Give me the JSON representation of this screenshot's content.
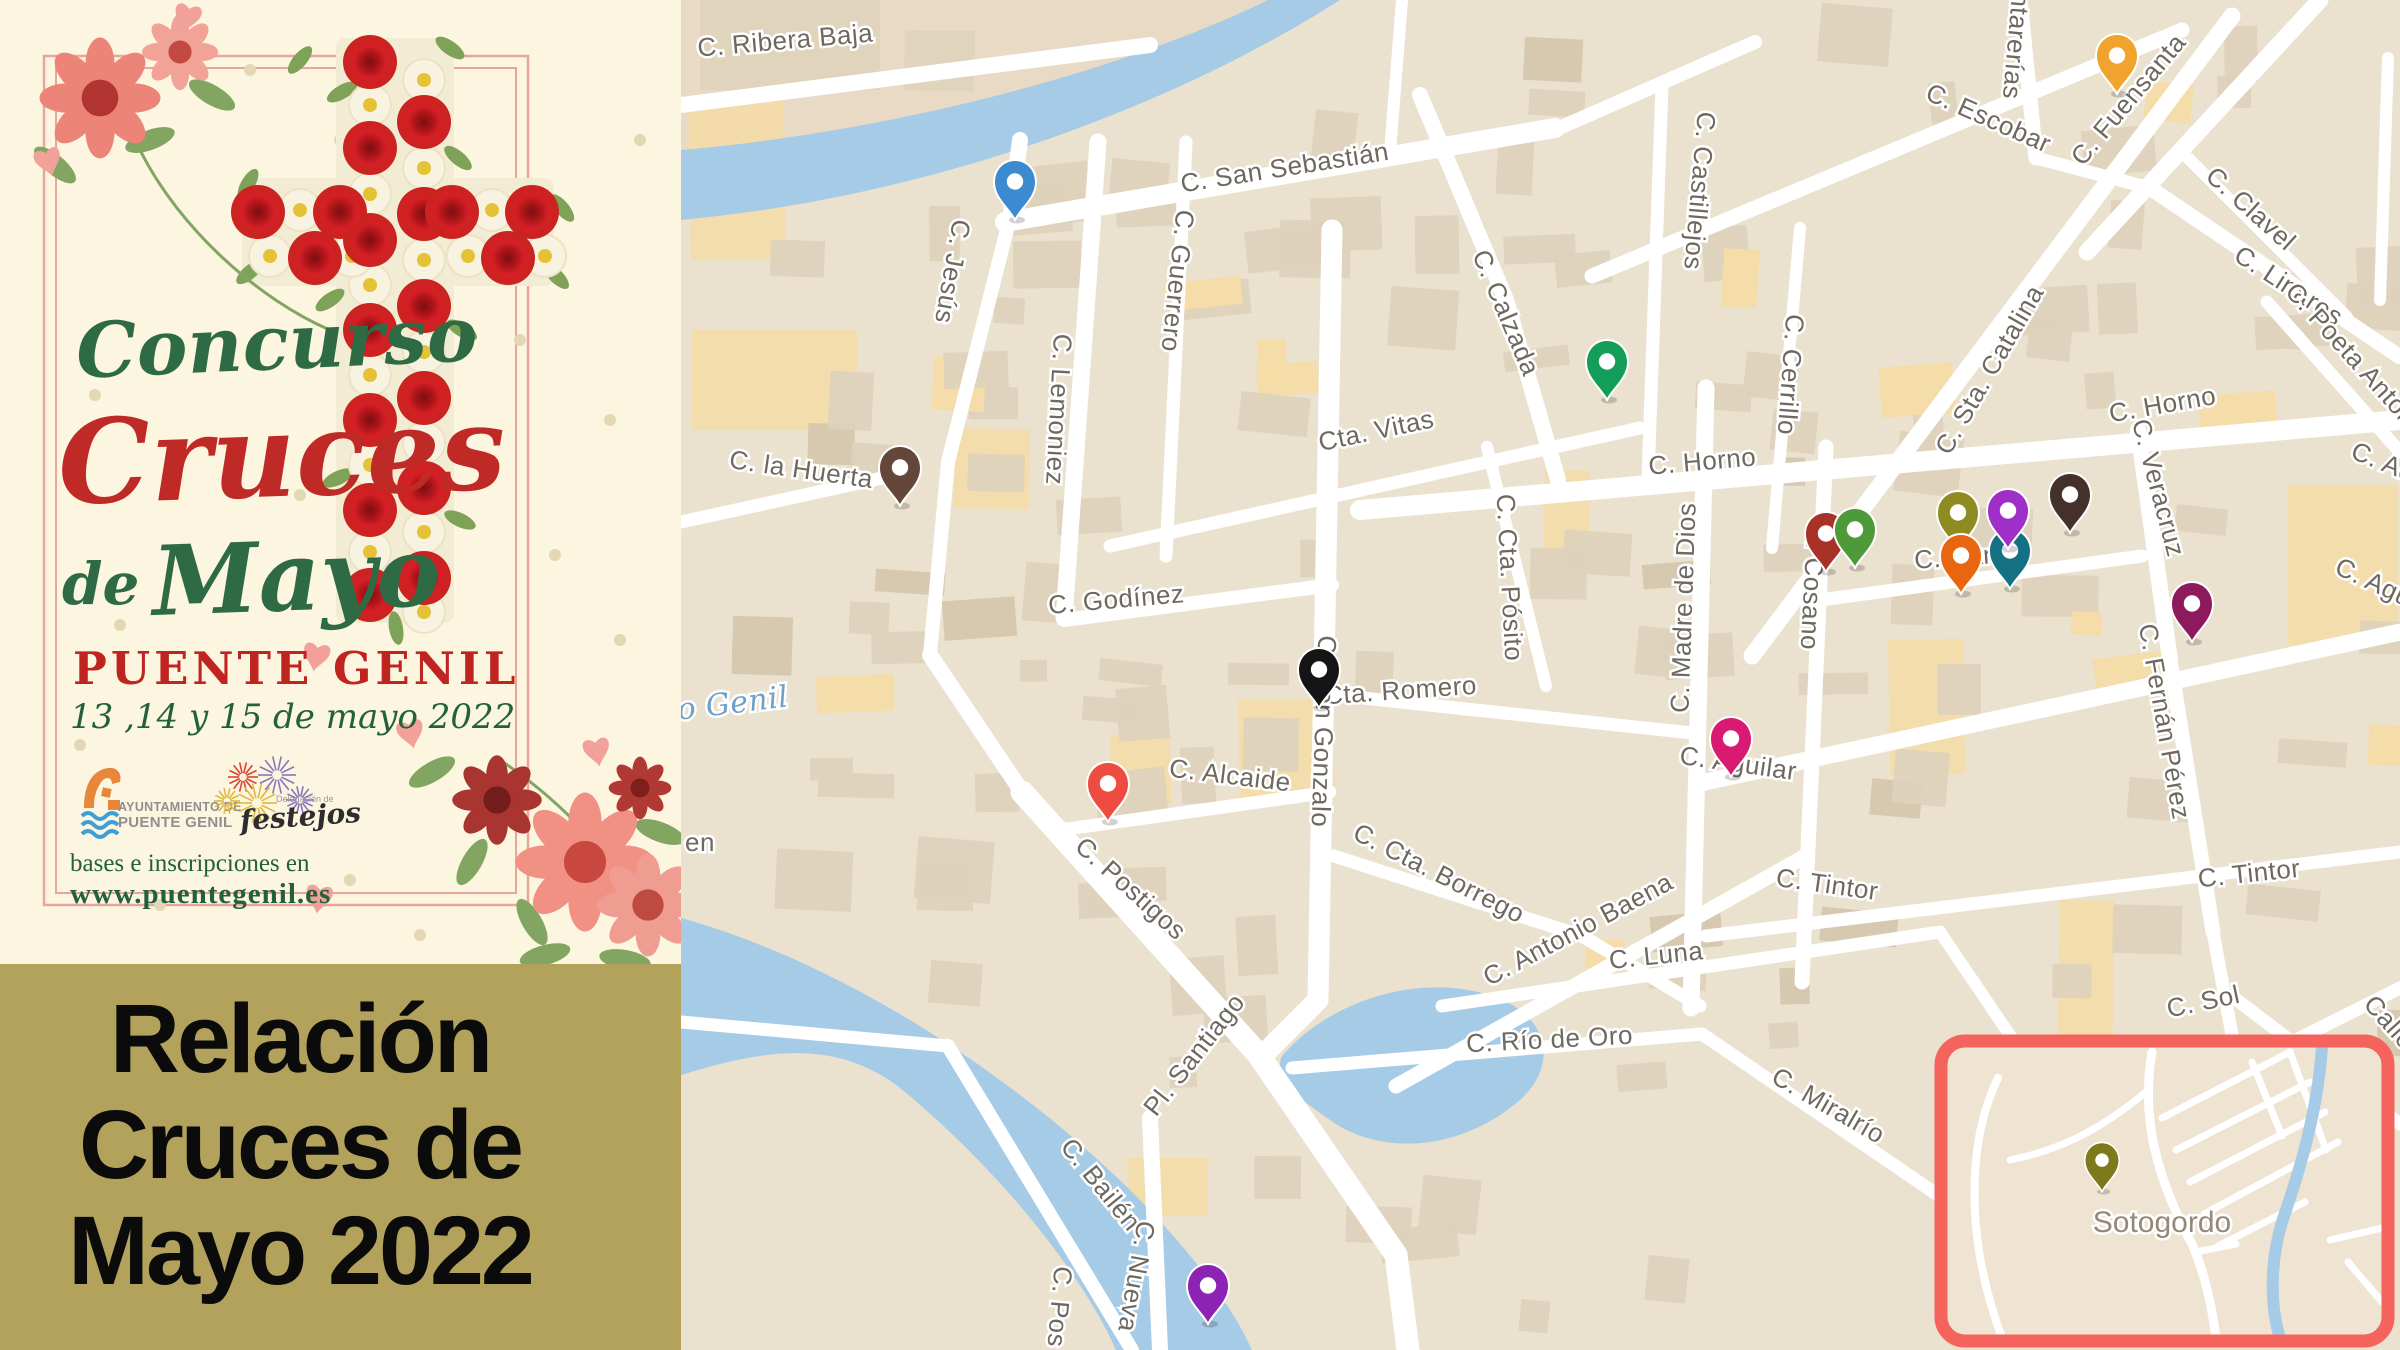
{
  "poster": {
    "title_word1": "Concurso",
    "title_word2": "Cruces",
    "title_word3a": "de",
    "title_word3b": "Mayo",
    "city": "PUENTE GENIL",
    "dates": "13 ,14 y 15 de mayo  2022",
    "ayto_logo_line1": "AYUNTAMIENTO DE",
    "ayto_logo_line2": "PUENTE GENIL",
    "festejos_small": "Delegación de",
    "festejos_word": "festejos",
    "info_line1": "bases e inscripciones en",
    "info_line2": "www.puentegenil.es"
  },
  "panel": {
    "line1": "Relación",
    "line2": "Cruces de",
    "line3": "Mayo 2022"
  },
  "map": {
    "street_labels": [
      {
        "t": "C. Ribera Baja",
        "x": 786,
        "y": 49,
        "r": -5
      },
      {
        "t": "C. San Sebastián",
        "x": 1286,
        "y": 176,
        "r": -9
      },
      {
        "t": "C. Jesús",
        "x": 944,
        "y": 270,
        "r": 100
      },
      {
        "t": "C. Lemoniez",
        "x": 1050,
        "y": 409,
        "r": 93
      },
      {
        "t": "C. Guerrero",
        "x": 1169,
        "y": 280,
        "r": 96
      },
      {
        "t": "C. la Huerta",
        "x": 800,
        "y": 478,
        "r": 8
      },
      {
        "t": "Cta. Vitas",
        "x": 1378,
        "y": 439,
        "r": -12
      },
      {
        "t": "C. Godínez",
        "x": 1117,
        "y": 608,
        "r": -5
      },
      {
        "t": "C. Calzada",
        "x": 1498,
        "y": 316,
        "r": 67
      },
      {
        "t": "C. Castillejos",
        "x": 1691,
        "y": 190,
        "r": 95
      },
      {
        "t": "C. Cerrillo",
        "x": 1782,
        "y": 374,
        "r": 94
      },
      {
        "t": "C. Escobar",
        "x": 1985,
        "y": 126,
        "r": 24
      },
      {
        "t": "C. Sta. Catalina",
        "x": 1997,
        "y": 374,
        "r": -60
      },
      {
        "t": "C. Linares",
        "x": 2284,
        "y": 293,
        "r": 33
      },
      {
        "t": "Cantarerías",
        "x": 2009,
        "y": 28,
        "r": 95
      },
      {
        "t": "C. Fuensanta",
        "x": 2135,
        "y": 105,
        "r": -50
      },
      {
        "t": "C. Clavel",
        "x": 2245,
        "y": 215,
        "r": 42
      },
      {
        "t": "C. Poeta Antonio",
        "x": 2352,
        "y": 368,
        "r": 48
      },
      {
        "t": "C. Horno",
        "x": 1703,
        "y": 470,
        "r": -5
      },
      {
        "t": "C. Horno",
        "x": 2164,
        "y": 413,
        "r": -10
      },
      {
        "t": "C. Veracruz",
        "x": 2150,
        "y": 490,
        "r": 75
      },
      {
        "t": "C. Cosano",
        "x": 1804,
        "y": 586,
        "r": 93
      },
      {
        "t": "C. Madre de Dios",
        "x": 1692,
        "y": 608,
        "r": -88
      },
      {
        "t": "Cta. Romero",
        "x": 1401,
        "y": 699,
        "r": -4
      },
      {
        "t": "C. Cta. Pósito",
        "x": 1501,
        "y": 578,
        "r": 87
      },
      {
        "t": "C. Alcaide",
        "x": 1229,
        "y": 784,
        "r": 7
      },
      {
        "t": "C. Postigos",
        "x": 1125,
        "y": 895,
        "r": 42
      },
      {
        "t": "C. Don Gonzalo",
        "x": 1315,
        "y": 731,
        "r": 92
      },
      {
        "t": "C. Cta. Borrego",
        "x": 1435,
        "y": 881,
        "r": 27
      },
      {
        "t": "C. Antonio Baena",
        "x": 1582,
        "y": 937,
        "r": -28
      },
      {
        "t": "C. Aguilar",
        "x": 1737,
        "y": 772,
        "r": 8
      },
      {
        "t": "C. Canto",
        "x": 1968,
        "y": 565,
        "r": -4
      },
      {
        "t": "C. Fernán Pérez",
        "x": 2156,
        "y": 723,
        "r": 80
      },
      {
        "t": "C. Tintor",
        "x": 1826,
        "y": 893,
        "r": 8
      },
      {
        "t": "C. Tintor",
        "x": 2250,
        "y": 882,
        "r": -6
      },
      {
        "t": "C. Luna",
        "x": 1657,
        "y": 964,
        "r": -6
      },
      {
        "t": "C. Río de Oro",
        "x": 1550,
        "y": 1048,
        "r": -3
      },
      {
        "t": "C. Miralrío",
        "x": 1824,
        "y": 1113,
        "r": 30
      },
      {
        "t": "C. Sol",
        "x": 2205,
        "y": 1010,
        "r": -12
      },
      {
        "t": "Pl. Santiago",
        "x": 1201,
        "y": 1060,
        "r": -52
      },
      {
        "t": "C. Bailén",
        "x": 1094,
        "y": 1190,
        "r": 51
      },
      {
        "t": "C. Nueva",
        "x": 1128,
        "y": 1275,
        "r": 100
      },
      {
        "t": "C. Pos",
        "x": 1051,
        "y": 1306,
        "r": 95
      },
      {
        "t": "C. Ad",
        "x": 2380,
        "y": 470,
        "r": 22
      },
      {
        "t": "C. Agu",
        "x": 2370,
        "y": 590,
        "r": 25
      },
      {
        "t": "Calle",
        "x": 2383,
        "y": 1028,
        "r": 48
      },
      {
        "t": "en",
        "x": 700,
        "y": 851,
        "r": 0
      }
    ],
    "water_label": {
      "t": "o Genil",
      "x": 734,
      "y": 713,
      "r": -7
    },
    "markers": [
      {
        "n": "blue",
        "c": "#3c8ad0",
        "x": 1015,
        "y": 218
      },
      {
        "n": "amber",
        "c": "#f0a42e",
        "x": 2117,
        "y": 92
      },
      {
        "n": "green",
        "c": "#129d58",
        "x": 1607,
        "y": 398
      },
      {
        "n": "brown",
        "c": "#64463a",
        "x": 900,
        "y": 504
      },
      {
        "n": "black",
        "c": "#151515",
        "x": 1319,
        "y": 706
      },
      {
        "n": "olive",
        "c": "#8e8c20",
        "x": 1958,
        "y": 549
      },
      {
        "n": "teal",
        "c": "#147083",
        "x": 2010,
        "y": 587
      },
      {
        "n": "dark-red",
        "c": "#a93226",
        "x": 1826,
        "y": 570
      },
      {
        "n": "green-2",
        "c": "#4e9a38",
        "x": 1855,
        "y": 566
      },
      {
        "n": "purple",
        "c": "#a02fc9",
        "x": 2008,
        "y": 547
      },
      {
        "n": "orange",
        "c": "#e8660f",
        "x": 1961,
        "y": 592
      },
      {
        "n": "dark-brown",
        "c": "#45312b",
        "x": 2070,
        "y": 531
      },
      {
        "n": "dark-magenta",
        "c": "#8e1a5e",
        "x": 2192,
        "y": 640
      },
      {
        "n": "pink",
        "c": "#d91a72",
        "x": 1731,
        "y": 775
      },
      {
        "n": "red",
        "c": "#ee4c41",
        "x": 1108,
        "y": 820
      },
      {
        "n": "purple-2",
        "c": "#8d23b5",
        "x": 1208,
        "y": 1322
      },
      {
        "n": "olive-inset",
        "c": "#7c7a1a",
        "x": 2102,
        "y": 1190,
        "s": 0.82
      }
    ],
    "roads": [
      [
        681,
        105,
        1150,
        45,
        16
      ],
      [
        1005,
        222,
        1555,
        128,
        20
      ],
      [
        1550,
        132,
        1755,
        42,
        14
      ],
      [
        1390,
        152,
        1402,
        0,
        12
      ],
      [
        1020,
        140,
        1010,
        220,
        16
      ],
      [
        1012,
        210,
        948,
        462,
        14
      ],
      [
        948,
        462,
        930,
        655,
        14
      ],
      [
        930,
        655,
        1022,
        792,
        16
      ],
      [
        681,
        522,
        905,
        473,
        13
      ],
      [
        1098,
        142,
        1064,
        618,
        17
      ],
      [
        1186,
        142,
        1166,
        556,
        13
      ],
      [
        1064,
        620,
        1332,
        585,
        14
      ],
      [
        1332,
        230,
        1318,
        1000,
        21
      ],
      [
        1318,
        1000,
        1262,
        1056,
        21
      ],
      [
        1022,
        792,
        1258,
        1054,
        23
      ],
      [
        1258,
        1054,
        1396,
        1255,
        23
      ],
      [
        1396,
        1255,
        1408,
        1350,
        23
      ],
      [
        681,
        1022,
        948,
        1046,
        13
      ],
      [
        948,
        1046,
        1132,
        1350,
        14
      ],
      [
        1150,
        1118,
        1160,
        1350,
        16
      ],
      [
        1060,
        830,
        1330,
        792,
        13
      ],
      [
        1325,
        694,
        1692,
        733,
        13
      ],
      [
        1487,
        447,
        1546,
        686,
        12
      ],
      [
        1110,
        546,
        1640,
        428,
        13
      ],
      [
        1420,
        95,
        1506,
        300,
        16
      ],
      [
        1506,
        300,
        1558,
        480,
        16
      ],
      [
        1662,
        85,
        1648,
        478,
        13
      ],
      [
        1800,
        228,
        1772,
        548,
        12
      ],
      [
        1360,
        510,
        2400,
        420,
        20
      ],
      [
        1592,
        276,
        2182,
        30,
        15
      ],
      [
        1752,
        656,
        2232,
        16,
        17
      ],
      [
        2020,
        0,
        2036,
        158,
        15
      ],
      [
        2036,
        158,
        2150,
        188,
        13
      ],
      [
        2320,
        0,
        2087,
        252,
        17
      ],
      [
        2150,
        188,
        2400,
        357,
        15
      ],
      [
        2182,
        152,
        2347,
        317,
        12
      ],
      [
        2267,
        302,
        2400,
        452,
        13
      ],
      [
        2388,
        58,
        2380,
        300,
        12
      ],
      [
        2138,
        430,
        2170,
        660,
        16
      ],
      [
        2170,
        660,
        2213,
        932,
        15
      ],
      [
        2213,
        932,
        2237,
        1062,
        13
      ],
      [
        1705,
        782,
        2400,
        632,
        17
      ],
      [
        1706,
        388,
        1691,
        1008,
        17
      ],
      [
        1826,
        447,
        1802,
        982,
        15
      ],
      [
        1806,
        602,
        2142,
        556,
        13
      ],
      [
        1334,
        856,
        1582,
        936,
        13
      ],
      [
        1582,
        936,
        1700,
        1006,
        13
      ],
      [
        1396,
        1086,
        1802,
        858,
        15
      ],
      [
        1706,
        936,
        2400,
        852,
        13
      ],
      [
        1442,
        1006,
        1940,
        932,
        13
      ],
      [
        1292,
        1068,
        1702,
        1034,
        13
      ],
      [
        1702,
        1034,
        1992,
        1232,
        13
      ],
      [
        1940,
        932,
        2062,
        1112,
        12
      ],
      [
        1952,
        1212,
        2400,
        988,
        13
      ],
      [
        2237,
        1000,
        2400,
        1124,
        13
      ]
    ],
    "water": [
      "M1268 0 C1150 58 930 128 681 150 L681 220 C940 196 1180 102 1340 0 Z",
      "M681 918 C840 962 1010 1072 1130 1190 C1190 1250 1232 1305 1252 1350 L1116 1350 C1086 1282 1010 1180 905 1092 C838 1036 762 1050 681 1075 Z",
      "M1282 1056 C1330 1000 1420 972 1492 996 C1548 1014 1560 1064 1520 1100 C1460 1152 1380 1156 1330 1120 C1298 1098 1272 1078 1282 1056 Z"
    ],
    "inset": {
      "x": 1941,
      "y": 1041,
      "w": 447,
      "h": 300,
      "label": {
        "t": "Sotogordo",
        "x": 2162,
        "y": 1232
      },
      "roads": [
        {
          "d": "M2152 1052 C2142 1110 2152 1170 2192 1244 C2206 1276 2212 1308 2216 1338",
          "w": 9
        },
        {
          "d": "M1998 1078 C1968 1140 1964 1235 2002 1338",
          "w": 8
        },
        {
          "d": "M2146 1092 C2100 1130 2060 1150 2010 1160",
          "w": 7
        },
        {
          "d": "M2162 1118 L2290 1052",
          "w": 7
        },
        {
          "d": "M2176 1150 L2310 1082",
          "w": 7
        },
        {
          "d": "M2190 1182 L2325 1112",
          "w": 7
        },
        {
          "d": "M2204 1214 L2338 1142",
          "w": 7
        },
        {
          "d": "M2218 1246 L2305 1202",
          "w": 7
        },
        {
          "d": "M2290 1052 L2326 1150",
          "w": 7
        },
        {
          "d": "M2252 1062 L2282 1136",
          "w": 7
        },
        {
          "d": "M2330 1240 L2382 1228",
          "w": 7
        },
        {
          "d": "M2348 1262 L2382 1302",
          "w": 7
        },
        {
          "d": "M2196 1252 L2236 1244",
          "w": 7
        }
      ],
      "river": "M2322 1046 C2318 1110 2300 1170 2282 1222 C2270 1262 2270 1306 2280 1338"
    }
  },
  "colors": {
    "land": "#ebe1cf",
    "land_tint": "#e8dac4",
    "building": "#ded2bc",
    "building_dark": "#d5c7ae",
    "building_peach": "#f5dca6",
    "road": "#ffffff",
    "water": "#a6cbe7",
    "label": "#6e6960",
    "water_label": "#6fa0c8",
    "inset_border": "#f4645c",
    "inset_land": "#efe4d2",
    "inset_label": "#93897b",
    "panel_bg": "#b2a25c",
    "poster_bg": "#fcf6e1",
    "poster_green": "#2e6b45",
    "poster_red": "#c02a26",
    "frame": "#e9a49c"
  }
}
